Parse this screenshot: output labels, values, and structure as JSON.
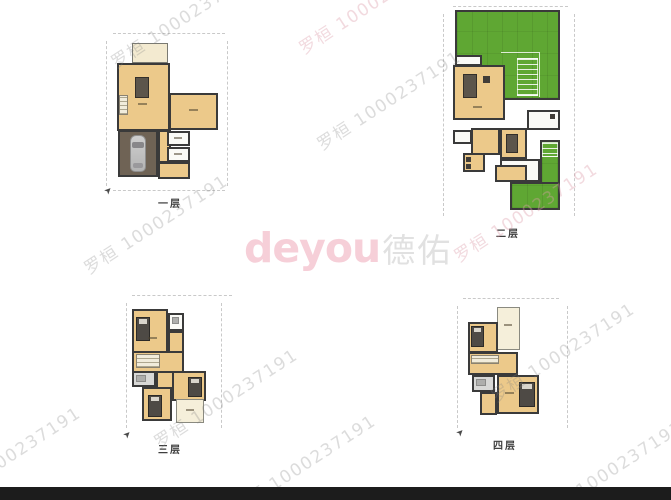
{
  "page": {
    "background": "#ffffff",
    "bottom_bar_color": "#1c1c1c"
  },
  "logo": {
    "latin": "deyou",
    "cjk": "德佑",
    "latin_color": "#f0a9ba",
    "cjk_color": "#c9c9c9"
  },
  "watermark": {
    "text": "罗桓 1000237191",
    "gray_color": "#828282",
    "pink_color": "#de9eaa"
  },
  "floors": [
    {
      "id": "floor-1",
      "label": "一层"
    },
    {
      "id": "floor-2",
      "label": "二层"
    },
    {
      "id": "floor-3",
      "label": "三层"
    },
    {
      "id": "floor-4",
      "label": "四层"
    }
  ],
  "colors": {
    "room_tan": "#ecc98a",
    "porch_cream": "#f3ead0",
    "terrace_cream": "#f5efda",
    "white_room": "#fafaf6",
    "bath_gray": "#d8d8d6",
    "garage_brown": "#6f6355",
    "lawn_green": "#5fa733",
    "wall": "#3a3a3a"
  }
}
